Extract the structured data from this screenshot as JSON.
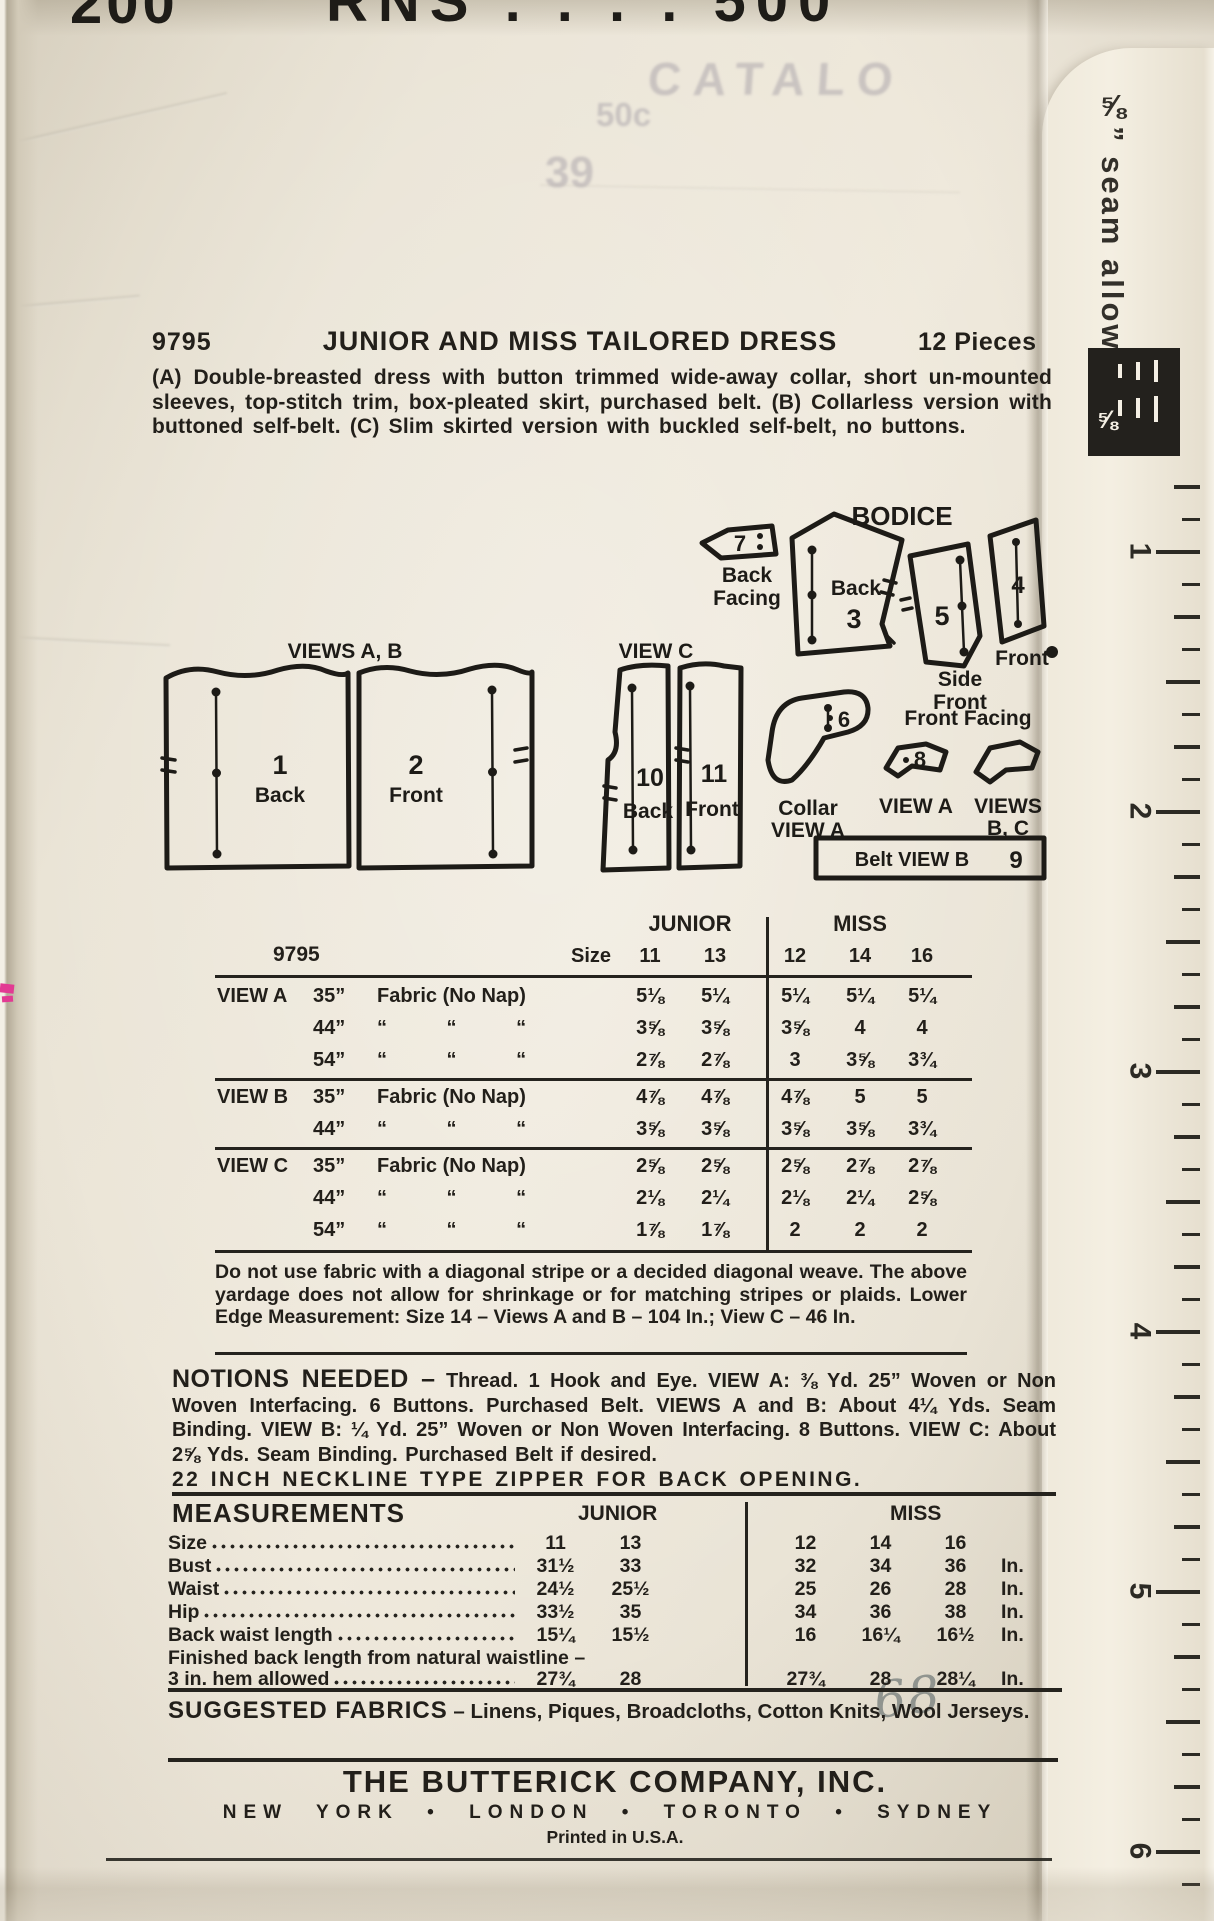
{
  "colors": {
    "ink": "#221f1a",
    "paper": "#eae4d6",
    "pink": "#e23a93"
  },
  "top_scraps": {
    "left": "200",
    "right": "RNS . . . . 500"
  },
  "ghost": {
    "catalog": "CATALO",
    "price": "50c",
    "number": "39"
  },
  "header": {
    "pattern_number": "9795",
    "title": "JUNIOR AND MISS TAILORED DRESS",
    "pieces": "12 Pieces"
  },
  "description": "(A) Double-breasted dress with button trimmed wide-away collar, short un-mounted sleeves, top-stitch trim, box-pleated skirt, purchased belt. (B) Collarless version with buttoned self-belt. (C) Slim skirted version with buckled self-belt, no buttons.",
  "diagram": {
    "bodice_label": "BODICE",
    "views_ab_label": "VIEWS A, B",
    "view_c_label": "VIEW C",
    "front_facing_label": "Front Facing",
    "pieces": {
      "p1": {
        "num": "1",
        "name": "Back"
      },
      "p2": {
        "num": "2",
        "name": "Front"
      },
      "p10": {
        "num": "10",
        "name": "Back"
      },
      "p11": {
        "num": "11",
        "name": "Front"
      },
      "p7": {
        "num": "7",
        "name1": "Back",
        "name2": "Facing"
      },
      "p3": {
        "num": "3",
        "name": "Back"
      },
      "p5": {
        "num": "5",
        "name1": "Side",
        "name2": "Front"
      },
      "p4": {
        "num": "4",
        "name": "Front"
      },
      "p6": {
        "num": "6",
        "name1": "Collar",
        "name2": "VIEW A"
      },
      "p8": {
        "num": "8",
        "name": "VIEW A"
      },
      "pbc": {
        "name1": "VIEWS",
        "name2": "B, C"
      },
      "belt": {
        "label": "Belt  VIEW B",
        "num": "9"
      }
    }
  },
  "yardage": {
    "number": "9795",
    "size_label": "Size",
    "junior_label": "JUNIOR",
    "miss_label": "MISS",
    "junior_sizes": [
      "11",
      "13"
    ],
    "miss_sizes": [
      "12",
      "14",
      "16"
    ],
    "rows": [
      {
        "view": "VIEW A",
        "width": "35”",
        "fabric": "Fabric (No Nap)",
        "ditto": false,
        "rule_before": false,
        "junior": [
          "5⅛",
          "5¼"
        ],
        "miss": [
          "5¼",
          "5¼",
          "5¼"
        ]
      },
      {
        "view": "",
        "width": "44”",
        "fabric": "“ “ “",
        "ditto": true,
        "rule_before": false,
        "junior": [
          "3⅝",
          "3⅝"
        ],
        "miss": [
          "3⅝",
          "4",
          "4"
        ]
      },
      {
        "view": "",
        "width": "54”",
        "fabric": "“ “ “",
        "ditto": true,
        "rule_before": false,
        "junior": [
          "2⅞",
          "2⅞"
        ],
        "miss": [
          "3",
          "3⅝",
          "3¾"
        ]
      },
      {
        "view": "VIEW B",
        "width": "35”",
        "fabric": "Fabric (No Nap)",
        "ditto": false,
        "rule_before": true,
        "junior": [
          "4⅞",
          "4⅞"
        ],
        "miss": [
          "4⅞",
          "5",
          "5"
        ]
      },
      {
        "view": "",
        "width": "44”",
        "fabric": "“ “ “",
        "ditto": true,
        "rule_before": false,
        "junior": [
          "3⅝",
          "3⅝"
        ],
        "miss": [
          "3⅝",
          "3⅝",
          "3¾"
        ]
      },
      {
        "view": "VIEW C",
        "width": "35”",
        "fabric": "Fabric (No Nap)",
        "ditto": false,
        "rule_before": true,
        "junior": [
          "2⅝",
          "2⅝"
        ],
        "miss": [
          "2⅝",
          "2⅞",
          "2⅞"
        ]
      },
      {
        "view": "",
        "width": "44”",
        "fabric": "“ “ “",
        "ditto": true,
        "rule_before": false,
        "junior": [
          "2⅛",
          "2¼"
        ],
        "miss": [
          "2⅛",
          "2¼",
          "2⅝"
        ]
      },
      {
        "view": "",
        "width": "54”",
        "fabric": "“ “ “",
        "ditto": true,
        "rule_before": false,
        "junior": [
          "1⅞",
          "1⅞"
        ],
        "miss": [
          "2",
          "2",
          "2"
        ]
      }
    ]
  },
  "note": "Do not use fabric with a diagonal stripe or a decided diagonal weave. The above yardage does not allow for shrinkage or for matching stripes or plaids. Lower Edge Measurement: Size 14 – Views A and B – 104 In.; View C – 46 In.",
  "notions": {
    "heading": "NOTIONS NEEDED –",
    "body": "Thread. 1 Hook and Eye. VIEW A: ⅜ Yd. 25” Woven or Non Woven Interfacing. 6 Buttons. Purchased Belt. VIEWS A and B: About 4¼ Yds. Seam Binding. VIEW B: ¼ Yd. 25” Woven or Non Woven Interfacing. 8 Buttons. VIEW C: About 2⅝ Yds. Seam Binding. Purchased Belt if desired.",
    "zipper_line": "22 INCH NECKLINE TYPE ZIPPER FOR BACK OPENING."
  },
  "measurements": {
    "title": "MEASUREMENTS",
    "junior_label": "JUNIOR",
    "miss_label": "MISS",
    "rows": [
      {
        "label": "Size",
        "label2": "",
        "junior": [
          "11",
          "13"
        ],
        "miss": [
          "12",
          "14",
          "16"
        ],
        "unit": ""
      },
      {
        "label": "Bust",
        "label2": "",
        "junior": [
          "31½",
          "33"
        ],
        "miss": [
          "32",
          "34",
          "36"
        ],
        "unit": "In."
      },
      {
        "label": "Waist",
        "label2": "",
        "junior": [
          "24½",
          "25½"
        ],
        "miss": [
          "25",
          "26",
          "28"
        ],
        "unit": "In."
      },
      {
        "label": "Hip",
        "label2": "",
        "junior": [
          "33½",
          "35"
        ],
        "miss": [
          "34",
          "36",
          "38"
        ],
        "unit": "In."
      },
      {
        "label": "Back waist length",
        "label2": "",
        "junior": [
          "15¼",
          "15½"
        ],
        "miss": [
          "16",
          "16¼",
          "16½"
        ],
        "unit": "In."
      },
      {
        "label": "Finished back length from natural waistline –",
        "label2": "3 in. hem allowed",
        "junior": [
          "27¾",
          "28"
        ],
        "miss": [
          "27¾",
          "28",
          "28¼"
        ],
        "unit": "In."
      }
    ]
  },
  "fabrics": {
    "heading": "SUGGESTED FABRICS",
    "body": "– Linens, Piques, Broadcloths, Cotton Knits, Wool Jerseys."
  },
  "footer": {
    "company": "THE BUTTERICK COMPANY, INC.",
    "cities": "NEW YORK • LONDON • TORONTO • SYDNEY",
    "printed": "Printed in U.S.A."
  },
  "ruler": {
    "label": "⅝” seam allowance",
    "zone_label": "⅝",
    "numbers": [
      "1",
      "2",
      "3",
      "4",
      "5",
      "6"
    ]
  },
  "pencil_note": "68"
}
